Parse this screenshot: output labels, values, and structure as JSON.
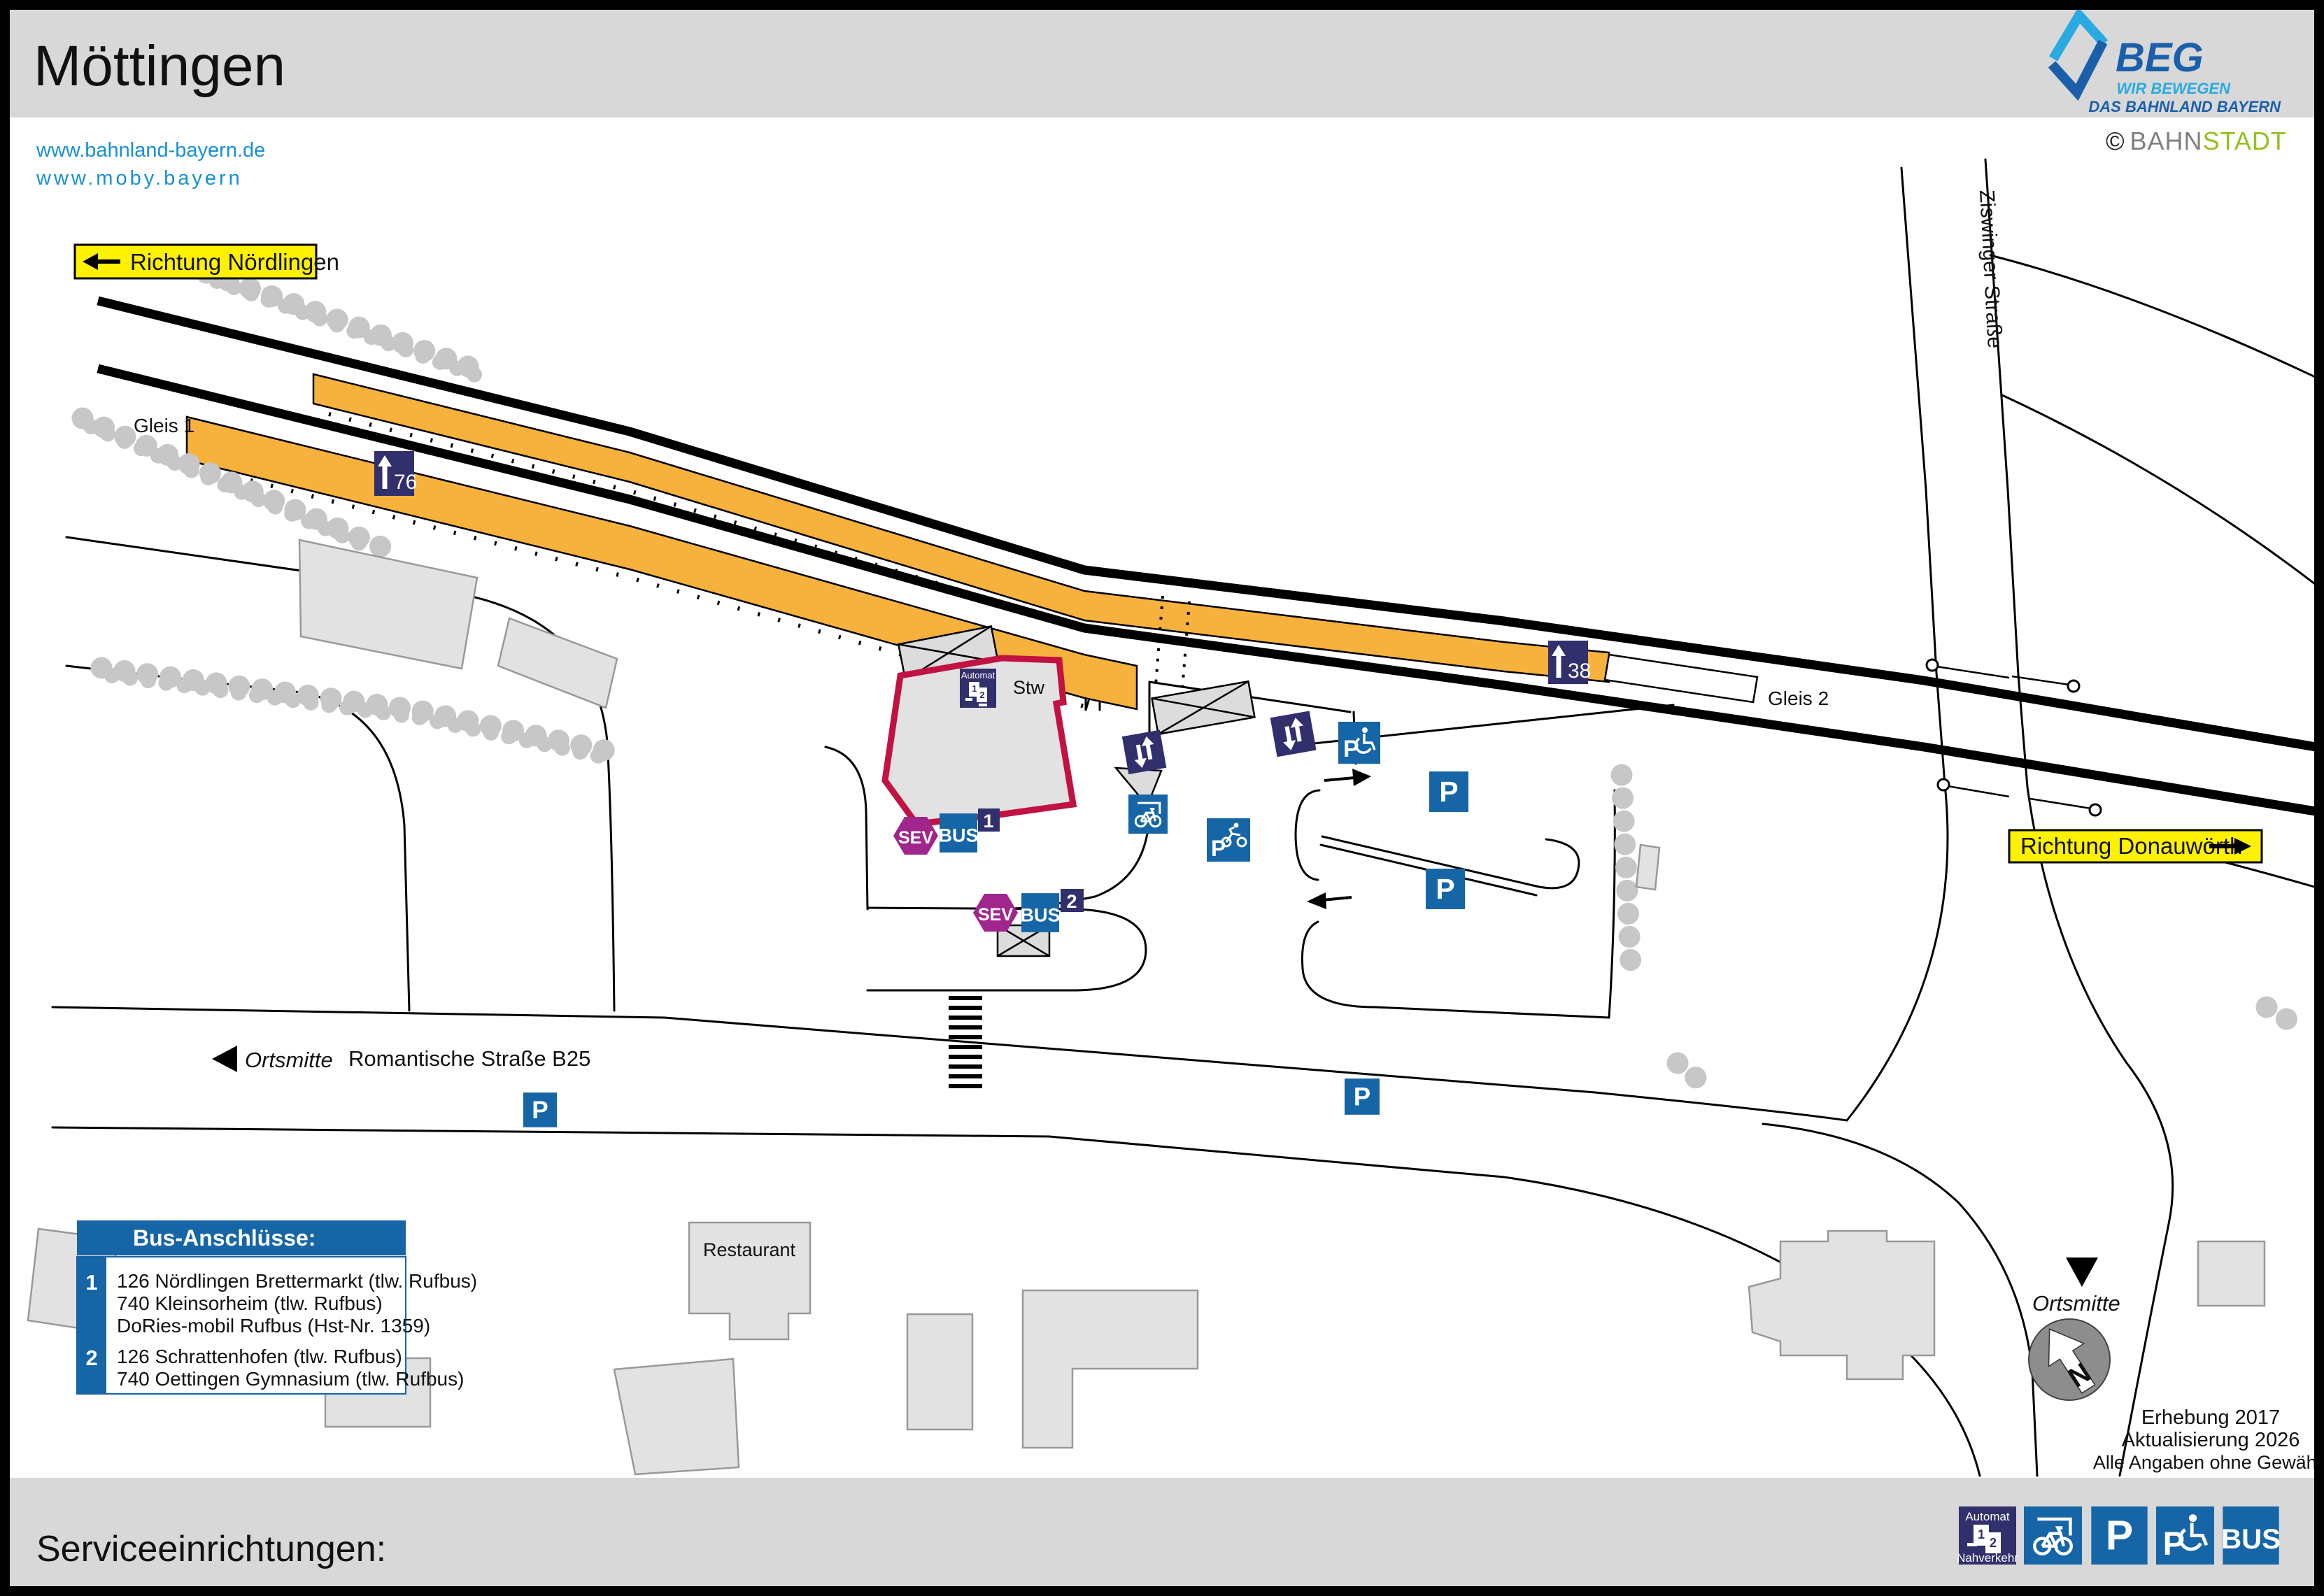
{
  "header": {
    "title": "Möttingen",
    "links": [
      "www.bahnland-bayern.de",
      "www.moby.bayern"
    ]
  },
  "branding": {
    "beg_name": "BEG",
    "beg_tagline1": "WIR BEWEGEN",
    "beg_tagline2": "DAS BAHNLAND BAYERN",
    "copyright_symbol": "©",
    "copyright_part1": "BAHN",
    "copyright_part2": "STADT"
  },
  "signs": {
    "nordlingen": "Richtung Nördlingen",
    "donauwoerth": "Richtung Donauwörth"
  },
  "labels": {
    "gleis1": "Gleis 1",
    "gleis2": "Gleis 2",
    "stw": "Stw",
    "ziswinger": "Ziswinger Straße",
    "romantische": "Romantische Straße B25",
    "ortsmitte": "Ortsmitte",
    "restaurant": "Restaurant",
    "north": "N"
  },
  "markers": {
    "platform_height_1": "76",
    "platform_height_2": "38"
  },
  "stops": {
    "sev": "SEV",
    "bus": "BUS",
    "no1": "1",
    "no2": "2"
  },
  "icons": {
    "p": "P",
    "automat_line1": "Automat",
    "automat_line2": "Nahverkehr"
  },
  "legend": {
    "title": "Bus-Anschlüsse:",
    "entries": [
      {
        "no": "1",
        "lines": [
          "126 Nördlingen Brettermarkt (tlw. Rufbus)",
          "740 Kleinsorheim (tlw. Rufbus)",
          "DoRies-mobil Rufbus (Hst-Nr. 1359)"
        ]
      },
      {
        "no": "2",
        "lines": [
          "126 Schrattenhofen (tlw. Rufbus)",
          "740 Oettingen Gymnasium (tlw. Rufbus)"
        ]
      }
    ]
  },
  "footer": {
    "title": "Serviceeinrichtungen:"
  },
  "meta": {
    "survey": "Erhebung 2017",
    "update": "Aktualisierung 2026",
    "disclaimer": "Alle Angaben ohne Gewähr!"
  },
  "colors": {
    "orange": "#F7B13D",
    "sign_yellow": "#FFF200",
    "navy": "#322F6D",
    "blue": "#1565A7",
    "magenta": "#A0268D",
    "red": "#C11242",
    "link": "#1890D5",
    "beg_blue": "#1B5FAA",
    "beg_cyan": "#29ABE2",
    "bahnstadt_gray": "#7F7F7F",
    "bahnstadt_green": "#94C01C",
    "band_gray": "#D8D8D8",
    "bldg": "#E2E2E2",
    "tree": "#C7C7C7"
  }
}
